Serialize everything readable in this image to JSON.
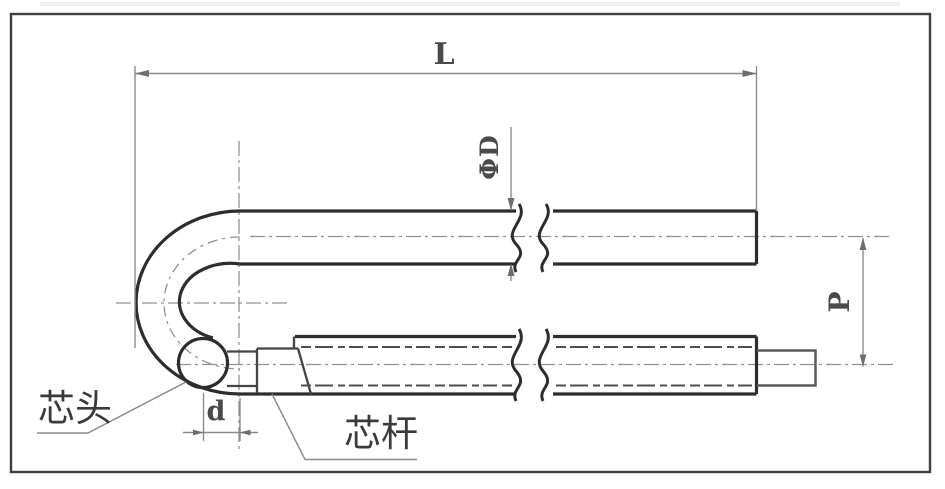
{
  "drawing": {
    "type": "technical-drawing",
    "subject": "U-shaped tubular heating element with core head and core rod",
    "dimension_labels": {
      "overall_length": "L",
      "tube_diameter": "ΦD",
      "leg_pitch": "P",
      "core_head_diameter": "d"
    },
    "part_labels": {
      "core_head": "芯头",
      "core_rod": "芯杆"
    },
    "colors": {
      "outline": "#2d2d2d",
      "dimension": "#8a8a8a",
      "text": "#3a3a3a",
      "dimtext": "#4a4a4a",
      "frame": "#3f3f3f",
      "background": "#ffffff"
    }
  }
}
